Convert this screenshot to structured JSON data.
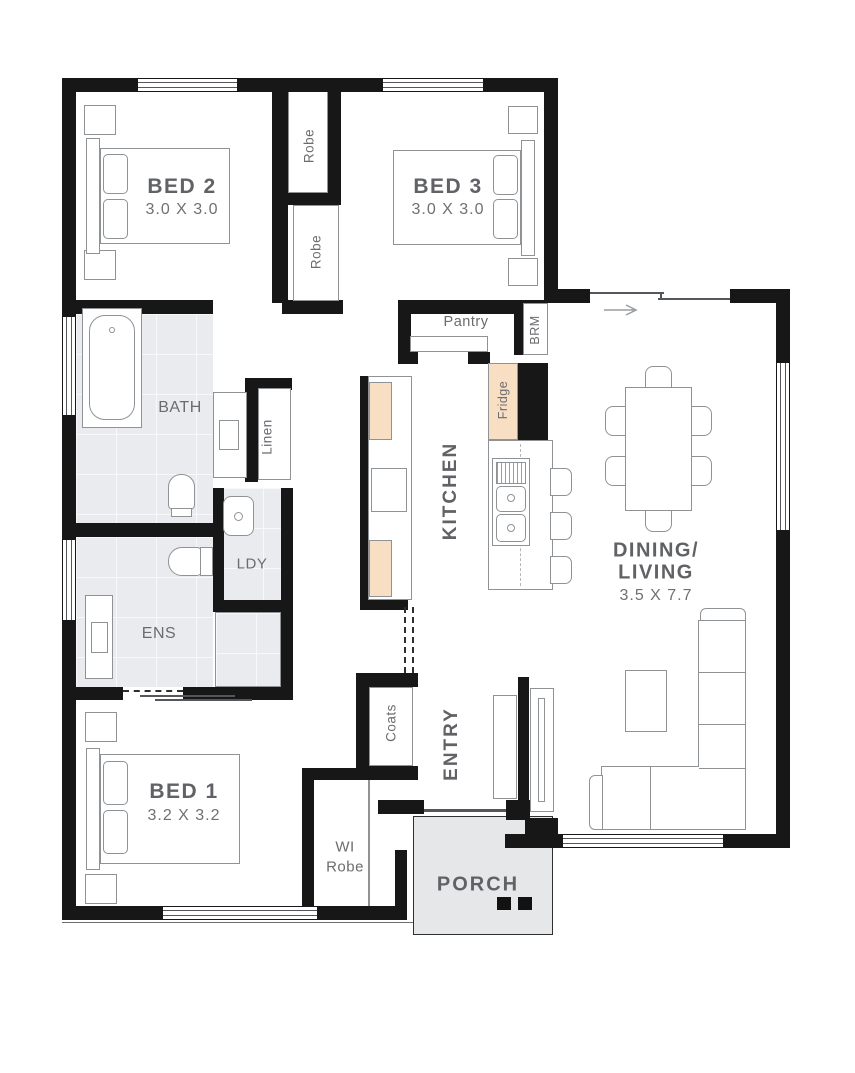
{
  "rooms": {
    "bed2": {
      "name": "BED 2",
      "dim": "3.0 X 3.0"
    },
    "bed3": {
      "name": "BED 3",
      "dim": "3.0 X 3.0"
    },
    "bed1": {
      "name": "BED 1",
      "dim": "3.2 X 3.2"
    },
    "dining_living": {
      "line1": "DINING/",
      "line2": "LIVING",
      "dim": "3.5 X 7.7"
    },
    "kitchen": {
      "name": "KITCHEN"
    },
    "entry": {
      "name": "ENTRY"
    },
    "porch": {
      "name": "PORCH"
    },
    "bath": {
      "name": "BATH"
    },
    "ens": {
      "name": "ENS"
    },
    "ldy": {
      "name": "LDY"
    },
    "linen": {
      "name": "Linen"
    },
    "robe_bed2": {
      "name": "Robe"
    },
    "robe_bed3": {
      "name": "Robe"
    },
    "pantry": {
      "name": "Pantry"
    },
    "brm": {
      "name": "BRM"
    },
    "fridge": {
      "name": "Fridge"
    },
    "coats": {
      "name": "Coats"
    },
    "wi_robe": {
      "line1": "WI",
      "line2": "Robe"
    }
  },
  "colors": {
    "wall": "#171717",
    "bench_highlight": "#f8dfc4",
    "tile_floor": "#e9ebee",
    "porch_floor": "#e6e7e9",
    "label_text": "#606265",
    "furniture_outline": "#8f9396"
  }
}
